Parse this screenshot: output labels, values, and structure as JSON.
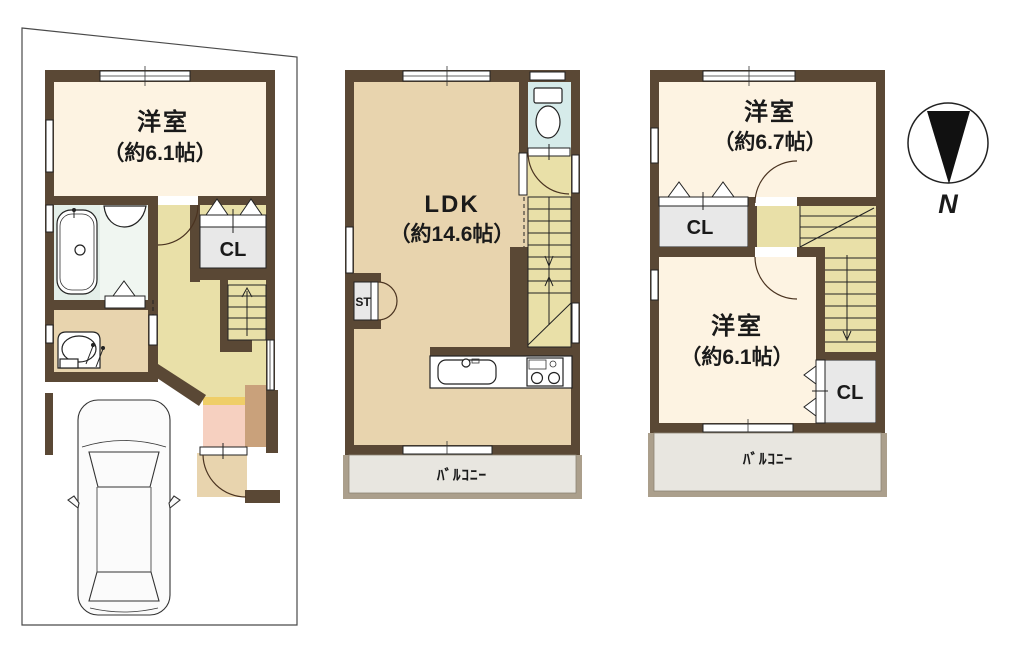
{
  "palette": {
    "wall_brown": "#5a4835",
    "room_cream": "#fdf3e2",
    "hall_khaki": "#e9e0a8",
    "floor_beige": "#e8d4ae",
    "bath_mint": "#e4efe9",
    "toilet_cyan": "#d6ebea",
    "entrance_pink": "#f6d0c0",
    "step_yellow": "#efce68",
    "cabinet_brown": "#c9a17b",
    "closet_gray": "#e8e8e8",
    "balcony_wall": "#ab9f8c",
    "balcony_floor": "#e8e6e0"
  },
  "floors": {
    "f1": {
      "room_label": "洋室",
      "room_size": "（約6.1帖）",
      "closet": "CL"
    },
    "f2": {
      "ldk_label": "LDK",
      "ldk_size": "（約14.6帖）",
      "storage": "ST",
      "balcony": "ﾊﾞﾙｺﾆｰ"
    },
    "f3": {
      "room_a_label": "洋室",
      "room_a_size": "（約6.7帖）",
      "closet_a": "CL",
      "room_b_label": "洋室",
      "room_b_size": "（約6.1帖）",
      "closet_b": "CL",
      "balcony": "ﾊﾞﾙｺﾆｰ"
    }
  },
  "compass": {
    "north_label": "N"
  }
}
